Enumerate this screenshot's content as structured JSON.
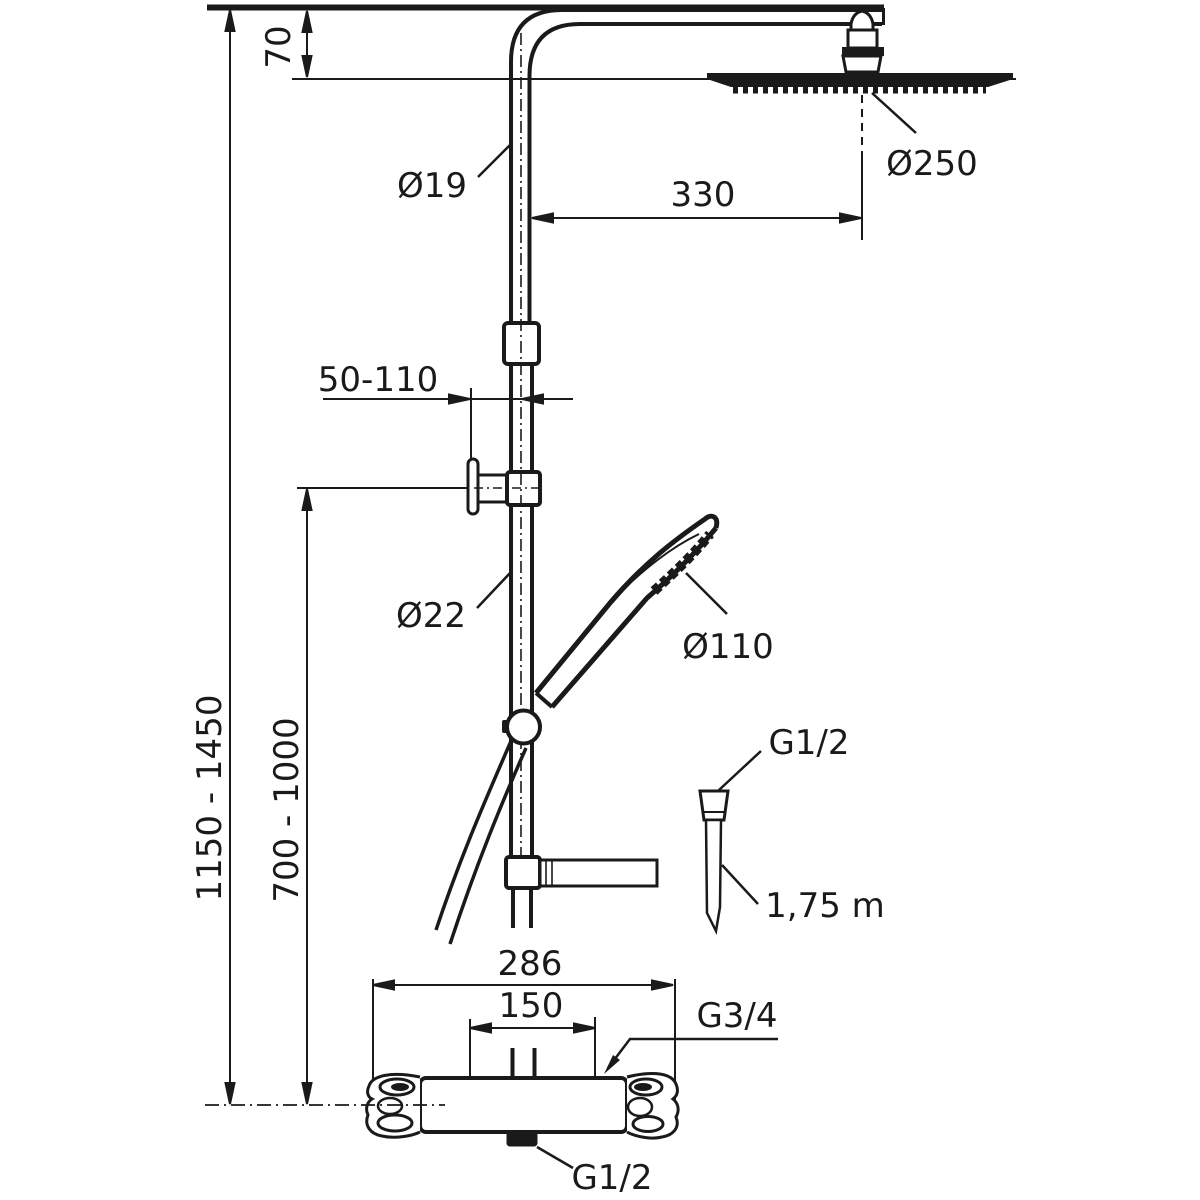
{
  "drawing": {
    "type": "technical-dimension-drawing",
    "subject": "shower system with overhead shower, hand shower and thermostatic mixer",
    "colors": {
      "line": "#1a1a1a",
      "background": "#ffffff"
    },
    "dimensions": {
      "ceiling_to_head": "70",
      "riser_pipe_diameter_upper": "Ø19",
      "head_horizontal_offset": "330",
      "overhead_shower_diameter": "Ø250",
      "wall_bracket_reach_range": "50-110",
      "riser_pipe_diameter_lower": "Ø22",
      "hand_shower_diameter": "Ø110",
      "hose_connection_thread": "G1/2",
      "hose_length": "1,75 m",
      "mixer_total_width": "286",
      "inlet_centres": "150",
      "inlet_connection_thread": "G3/4",
      "outlet_connection_thread": "G1/2",
      "overall_height_range": "1150 - 1450",
      "bracket_height_range": "700 - 1000"
    }
  }
}
